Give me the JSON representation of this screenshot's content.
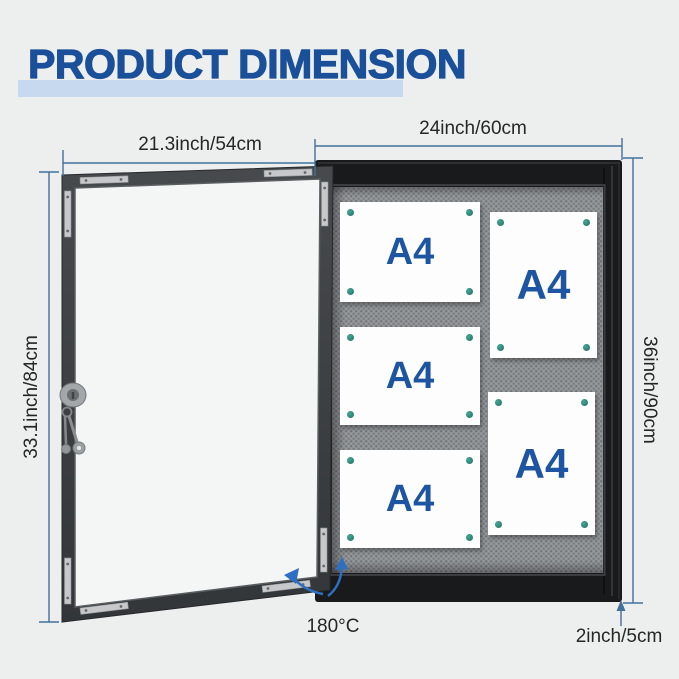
{
  "title": "PRODUCT DIMENSION",
  "door": {
    "width_label": "21.3inch/54cm",
    "height_label": "33.1inch/84cm"
  },
  "board": {
    "width_label": "24inch/60cm",
    "height_label": "36inch/90cm",
    "depth_label": "2inch/5cm",
    "papers": [
      {
        "label": "A4",
        "orientation": "landscape"
      },
      {
        "label": "A4",
        "orientation": "portrait"
      },
      {
        "label": "A4",
        "orientation": "landscape"
      },
      {
        "label": "A4",
        "orientation": "portrait"
      },
      {
        "label": "A4",
        "orientation": "landscape"
      }
    ]
  },
  "annotations": {
    "open_angle_label": "180°C"
  },
  "icons": [
    {
      "name": "lock-icon"
    },
    {
      "name": "keys-icon"
    },
    {
      "name": "swing-arrow-icon"
    },
    {
      "name": "pin-icon"
    },
    {
      "name": "corner-bracket-icon"
    }
  ],
  "colors": {
    "title_text": "#1a4f99",
    "title_highlight": "#c7d9ef",
    "dimension_line": "#41719c",
    "label_text": "#262626",
    "a4_text": "#1d55a3",
    "pin": "#2f8e7f",
    "board_frame": "#191a1c",
    "board_fabric": "#8f9295",
    "door_frame": "#3e4144",
    "glass": "#f4f5f5",
    "arrow": "#2e6fc3",
    "background": "#edefef"
  }
}
